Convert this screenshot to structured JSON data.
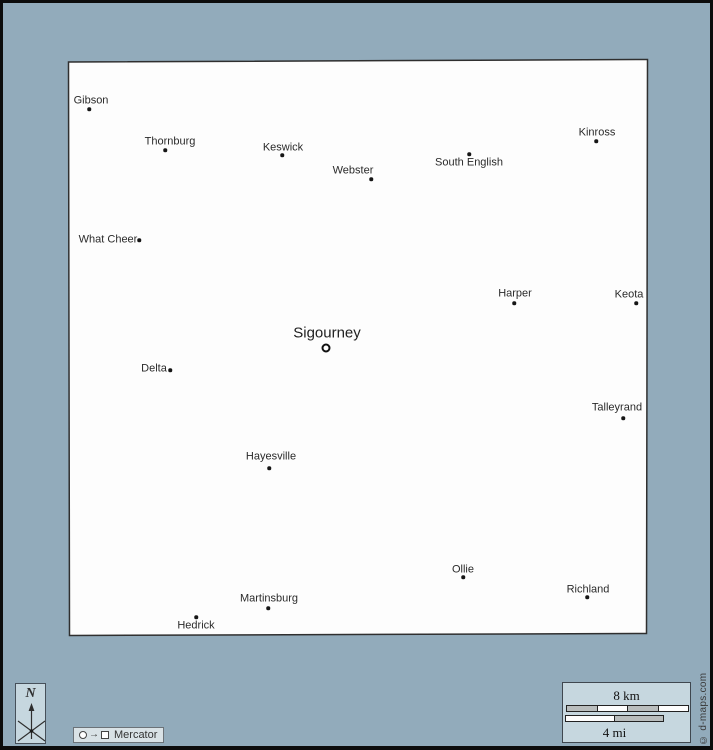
{
  "colors": {
    "background": "#92abbb",
    "frame_border": "#0c0c0c",
    "map_fill": "#fdfdfd",
    "map_border": "#2f2f2f",
    "dot": "#161616",
    "label": "#2a2a2a",
    "panel_fill": "#c6d7df",
    "badge_fill": "#d9e2e6",
    "bar_gray": "#b9bdbd",
    "bar_white": "#fdfdfd"
  },
  "map": {
    "outline": [
      [
        65.5,
        59
      ],
      [
        644.5,
        56.5
      ],
      [
        643.5,
        630.5
      ],
      [
        66.5,
        632.5
      ]
    ],
    "cities": [
      {
        "name": "Gibson",
        "dot": [
          86,
          106
        ],
        "label": [
          88,
          98
        ],
        "size": 11,
        "seat": false
      },
      {
        "name": "Thornburg",
        "dot": [
          162,
          147
        ],
        "label": [
          167,
          139
        ],
        "size": 11,
        "seat": false
      },
      {
        "name": "Keswick",
        "dot": [
          279,
          152
        ],
        "label": [
          280,
          145
        ],
        "size": 11,
        "seat": false
      },
      {
        "name": "Webster",
        "dot": [
          368,
          176
        ],
        "label": [
          350,
          168
        ],
        "size": 11,
        "seat": false
      },
      {
        "name": "South English",
        "dot": [
          466,
          151
        ],
        "label": [
          466,
          160
        ],
        "size": 11,
        "seat": false
      },
      {
        "name": "Kinross",
        "dot": [
          593,
          138
        ],
        "label": [
          594,
          130
        ],
        "size": 11,
        "seat": false
      },
      {
        "name": "What Cheer",
        "dot": [
          136,
          237
        ],
        "label": [
          105,
          237
        ],
        "size": 11,
        "seat": false
      },
      {
        "name": "Harper",
        "dot": [
          511,
          300
        ],
        "label": [
          512,
          291
        ],
        "size": 11,
        "seat": false
      },
      {
        "name": "Keota",
        "dot": [
          633,
          300
        ],
        "label": [
          626,
          292
        ],
        "size": 11,
        "seat": false
      },
      {
        "name": "Sigourney",
        "dot": [
          323,
          345
        ],
        "label": [
          324,
          330
        ],
        "size": 15,
        "seat": true
      },
      {
        "name": "Delta",
        "dot": [
          167,
          367
        ],
        "label": [
          151,
          366
        ],
        "size": 11,
        "seat": false
      },
      {
        "name": "Talleyrand",
        "dot": [
          620,
          415
        ],
        "label": [
          614,
          405
        ],
        "size": 11,
        "seat": false
      },
      {
        "name": "Hayesville",
        "dot": [
          266,
          465
        ],
        "label": [
          268,
          454
        ],
        "size": 11,
        "seat": false
      },
      {
        "name": "Ollie",
        "dot": [
          460,
          574
        ],
        "label": [
          460,
          567
        ],
        "size": 11,
        "seat": false
      },
      {
        "name": "Richland",
        "dot": [
          584,
          594
        ],
        "label": [
          585,
          587
        ],
        "size": 11,
        "seat": false
      },
      {
        "name": "Martinsburg",
        "dot": [
          265,
          605
        ],
        "label": [
          266,
          596
        ],
        "size": 11,
        "seat": false
      },
      {
        "name": "Hedrick",
        "dot": [
          193,
          614
        ],
        "label": [
          193,
          623
        ],
        "size": 11,
        "seat": false
      }
    ]
  },
  "north_indicator": {
    "label": "N"
  },
  "projection_badge": {
    "label": "Mercator",
    "icons": [
      "circle-icon",
      "right-arrow-icon",
      "square-icon"
    ]
  },
  "scale": {
    "km_label": "8 km",
    "mi_label": "4 mi",
    "km_segments": [
      "gray",
      "white",
      "gray",
      "white"
    ],
    "mi_segments": [
      "white",
      "gray"
    ]
  },
  "copyright": "© d-maps.com"
}
